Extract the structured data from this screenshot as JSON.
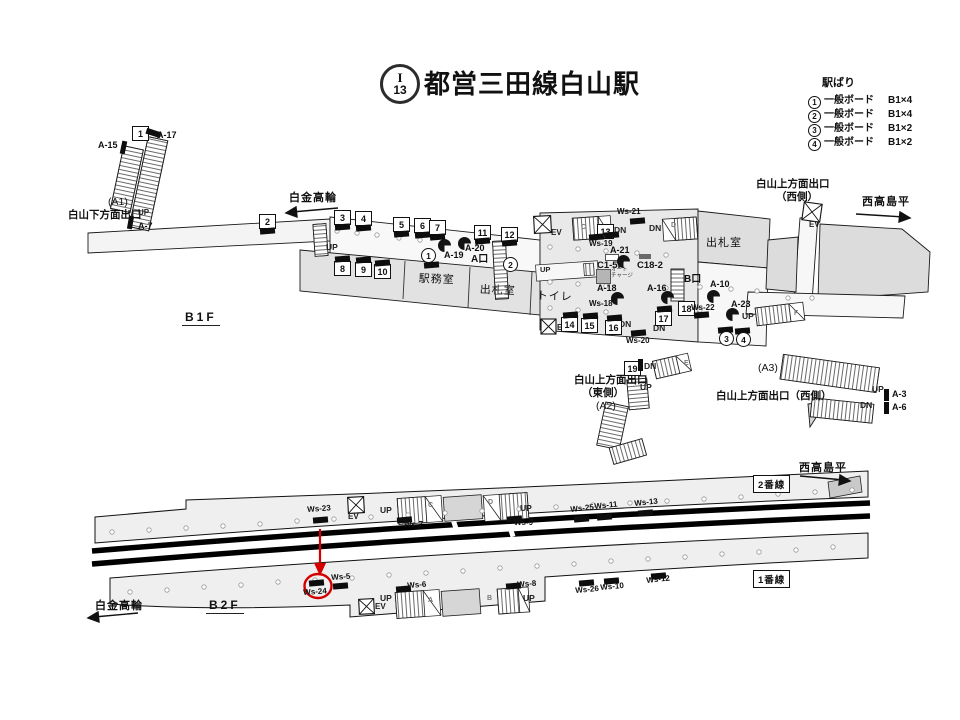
{
  "header": {
    "line_letter": "I",
    "line_number": "13",
    "station_title": "都営三田線白山駅"
  },
  "legend": {
    "title": "駅ばり",
    "items": [
      {
        "no": "1",
        "label": "一般ボード",
        "size": "B1×4"
      },
      {
        "no": "2",
        "label": "一般ボード",
        "size": "B1×4"
      },
      {
        "no": "3",
        "label": "一般ボード",
        "size": "B1×2"
      },
      {
        "no": "4",
        "label": "一般ボード",
        "size": "B1×2"
      }
    ]
  },
  "floors": {
    "b1f": "B1F",
    "b2f": "B2F"
  },
  "directions": {
    "shirokane_takanawa": "白金高輪",
    "nishi_takashimadaira": "西高島平"
  },
  "platforms": {
    "track1": "1番線",
    "track2": "2番線"
  },
  "exits": {
    "a1": "(A1)",
    "a2": "(A2)",
    "a3": "(A3)",
    "hakusan_shimo": "白山下方面出口",
    "hakusan_kami": "白山上方面出口",
    "east_side": "（東側）",
    "west_side": "（西側）",
    "hakusan_kami_west_inline": "白山上方面出口（西側）"
  },
  "rooms": {
    "ekimushitsu": "駅務室",
    "shussatsushitsu": "出札室",
    "toilet": "トイレ",
    "shussatsushitsu2": "出札室"
  },
  "gates": {
    "a": "A口",
    "b": "B口"
  },
  "marks": {
    "up": "UP",
    "dn": "DN",
    "ev": "EV"
  },
  "boards": {
    "1": "1",
    "2": "2",
    "3": "3",
    "4": "4",
    "5": "5",
    "6": "6",
    "7": "7",
    "8": "8",
    "9": "9",
    "10": "10",
    "11": "11",
    "12": "12",
    "13": "13",
    "14": "14",
    "15": "15",
    "16": "16",
    "17": "17",
    "18": "18",
    "19": "19"
  },
  "circled": {
    "1": "1",
    "2": "2",
    "3": "3",
    "4": "4"
  },
  "ads": {
    "a3": "A-3",
    "a6": "A-6",
    "a7": "A-7",
    "a10": "A-10",
    "a15": "A-15",
    "a16": "A-16",
    "a17": "A-17",
    "a18": "A-18",
    "a19": "A-19",
    "a20": "A-20",
    "a21": "A-21",
    "a23": "A-23",
    "c15k": "C1-5K",
    "c182": "C18-2"
  },
  "ws": {
    "ws5": "Ws-5",
    "ws6": "Ws-6",
    "ws7": "Ws-7",
    "ws8": "Ws-8",
    "ws9": "Ws-9",
    "ws10": "Ws-10",
    "ws11": "Ws-11",
    "ws12": "Ws-12",
    "ws13": "Ws-13",
    "ws18": "Ws-18",
    "ws19": "Ws-19",
    "ws20": "Ws-20",
    "ws21": "Ws-21",
    "ws22": "Ws-22",
    "ws23": "Ws-23",
    "ws24": "Ws-24",
    "ws25": "Ws-25",
    "ws26": "Ws-26"
  },
  "machines": {
    "auto_charge_line1": "オート",
    "auto_charge_line2": "チャージ"
  },
  "stair_letters": {
    "a": "A",
    "b": "B",
    "c": "C",
    "d": "D",
    "e": "E",
    "f": "F"
  },
  "colors": {
    "annotation_red": "#d40000",
    "room_gray": "#e2e2e2",
    "paid_area_gray": "#e9e9e9"
  }
}
